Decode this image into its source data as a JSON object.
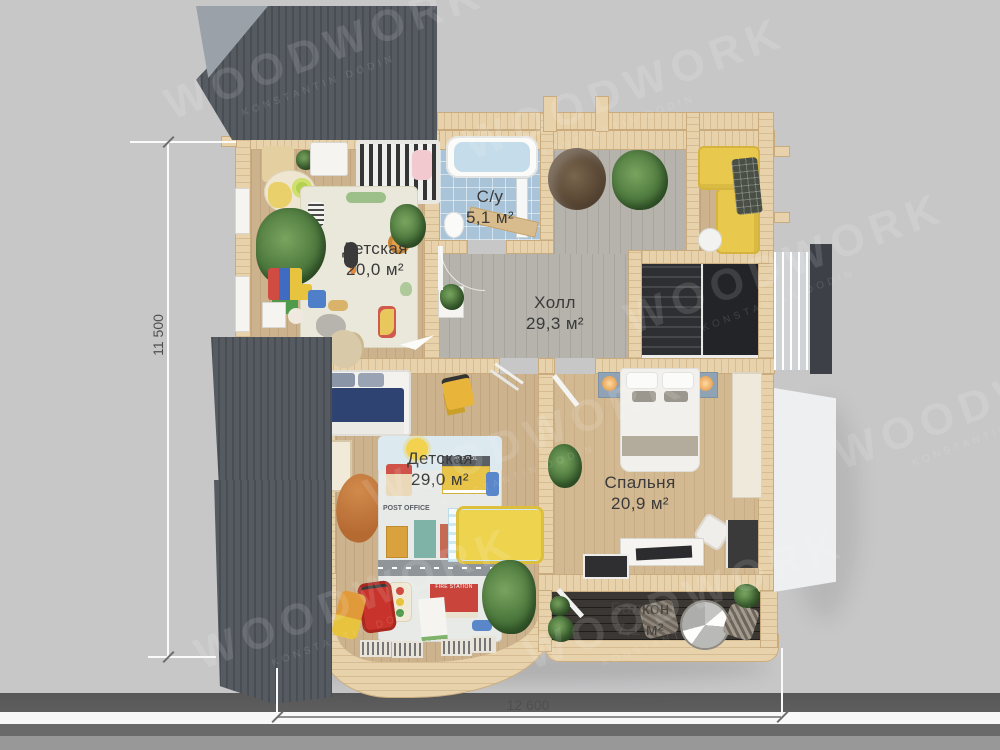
{
  "scene": {
    "description": "3D top-down floor plan render, second floor of wooden house"
  },
  "watermark": {
    "title": "WOODWORK",
    "subtitle": "KONSTANTIN DODIN"
  },
  "dimensions": {
    "height_label": "11 500",
    "width_label": "12 600"
  },
  "rooms": [
    {
      "id": "nursery-top",
      "name": "Детская",
      "area": "20,0 м²"
    },
    {
      "id": "bathroom",
      "name": "С/у",
      "area": "5,1 м²"
    },
    {
      "id": "hall",
      "name": "Холл",
      "area": "29,3 м²"
    },
    {
      "id": "nursery-bottom",
      "name": "Детская",
      "area": "29,0 м²"
    },
    {
      "id": "bedroom",
      "name": "Спальня",
      "area": "20,9 м²"
    },
    {
      "id": "balcony",
      "name": "Балкон",
      "area": "7,1 м²"
    }
  ],
  "playmat_labels": {
    "school": "SCHOOL",
    "post_office": "POST OFFICE",
    "fire_station": "FIRE STATION"
  },
  "colors": {
    "bg": "#c7c7c8",
    "backdrop-dark": "#5e5e5e",
    "backdrop-mid": "#6a6a6a",
    "backdrop-light": "#989898",
    "backdrop-white": "#f8f8f8",
    "roof": "#565b62",
    "roof-stripe": "#494e55",
    "roof-gable": "#9ba1a8",
    "wall": "#e7d2ac",
    "wall-edge": "#c9ab7d",
    "wood": "#ccb28d",
    "wood-warm": "#d3b992",
    "gray-floor": "#b6b3ac",
    "tile": "#a9c4d9",
    "deck": "#3b3733",
    "sofa-yellow": "#e9c84e",
    "bed-navy": "#2e4372",
    "toy-red": "#c8342b",
    "toddler-bed-yellow": "#eed34e",
    "dim-text": "#4f4f4f",
    "label-text": "#3a3a3a"
  }
}
